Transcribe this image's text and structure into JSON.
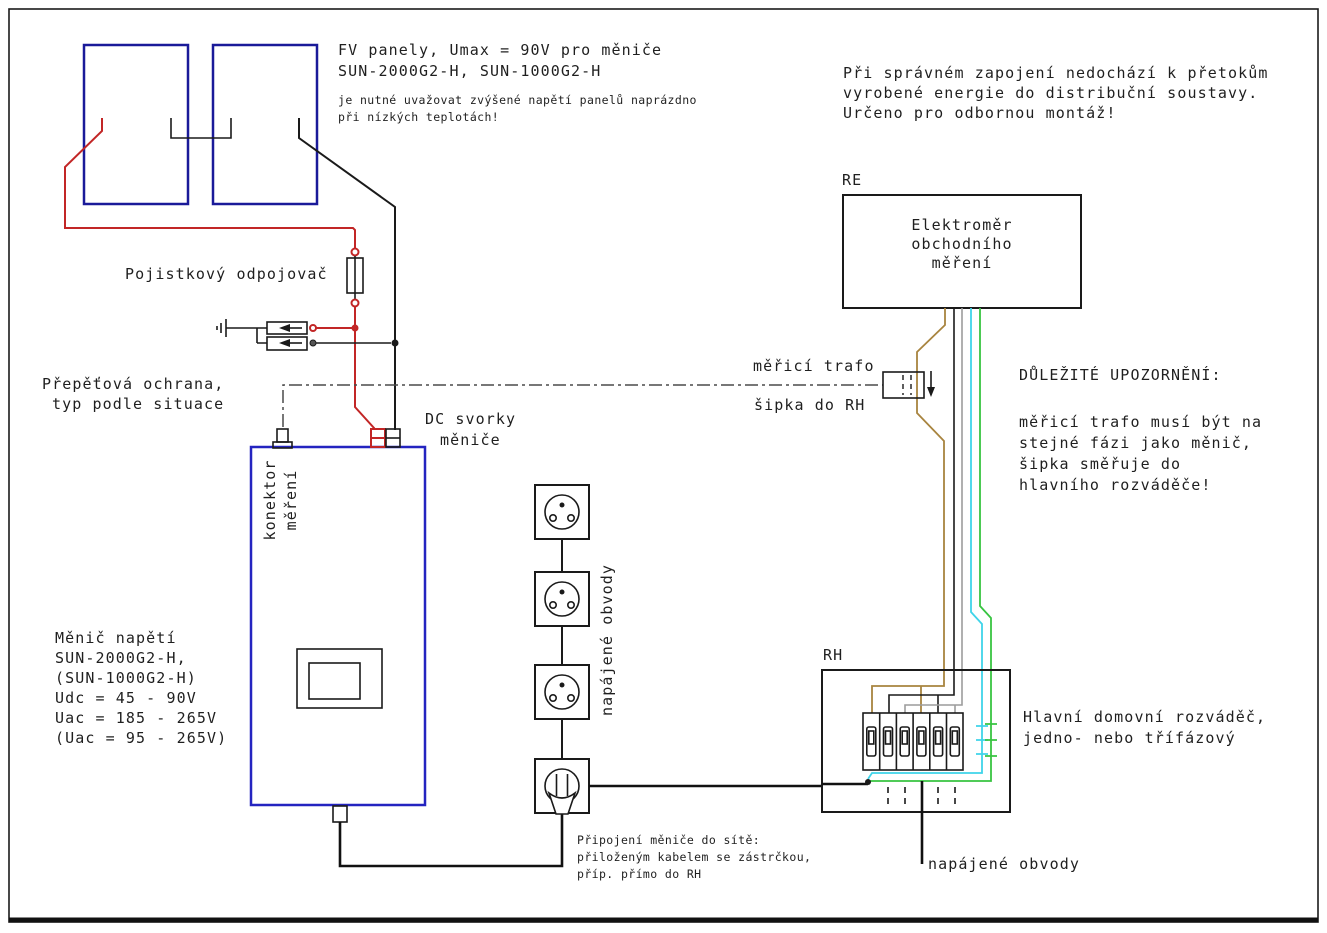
{
  "diagram_title": "FV / grid-tie inverter wiring diagram (Czech)",
  "colors": {
    "dc_plus_red": "#c22626",
    "dc_minus_black": "#1a1a1a",
    "phase_l1_brown": "#a8843f",
    "phase_l2_black": "#1a1a1a",
    "phase_l3_gray": "#9c9c9c",
    "neutral_cyan": "#3fd4e9",
    "pe_green": "#38c441",
    "pv_panel_outline": "#1a1a99",
    "inverter_outline": "#2424c0"
  },
  "pv": {
    "title1": "FV panely, Umax = 90V pro měniče",
    "title2": "SUN-2000G2-H, SUN-1000G2-H",
    "note1": "je nutné uvažovat zvýšené napětí panelů naprázdno",
    "note2": "při nízkých teplotách!"
  },
  "grid_warning": {
    "line1": "Při správném zapojení nedochází k přetokům",
    "line2": "vyrobené energie do distribuční soustavy.",
    "line3": "Určeno pro odbornou montáž!"
  },
  "meter": {
    "tag": "RE",
    "line1": "Elektroměr",
    "line2": "obchodního",
    "line3": "měření"
  },
  "fuse_label": "Pojistkový odpojovač",
  "spd": {
    "line1": "Přepěťová ochrana,",
    "line2": "typ podle situace"
  },
  "dc_terminals": {
    "line1": "DC svorky",
    "line2": "měniče"
  },
  "ct": {
    "line1": "měřicí trafo",
    "line2": "šipka do RH"
  },
  "important": {
    "title": "DŮLEŽITÉ UPOZORNĚNÍ:",
    "line1": "měřicí trafo musí být na",
    "line2": "stejné fázi jako měnič,",
    "line3": "šipka směřuje do",
    "line4": "hlavního rozváděče!"
  },
  "inverter": {
    "line1": "Měnič napětí",
    "line2": "SUN-2000G2-H,",
    "line3": "(SUN-1000G2-H)",
    "line4": "Udc = 45 - 90V",
    "line5": "Uac = 185 - 265V",
    "line6": "(Uac = 95 - 265V)",
    "connector_line1": "konektor",
    "connector_line2": "měření"
  },
  "circuits": {
    "vertical": "napájené obvody",
    "bottom": "napájené obvody"
  },
  "rh": {
    "tag": "RH",
    "desc1": "Hlavní domovní rozváděč,",
    "desc2": "jedno- nebo třífázový"
  },
  "plug_note": {
    "line1": "Připojení měniče do sítě:",
    "line2": "přiloženým kabelem se zástrčkou,",
    "line3": "příp. přímo do RH"
  }
}
